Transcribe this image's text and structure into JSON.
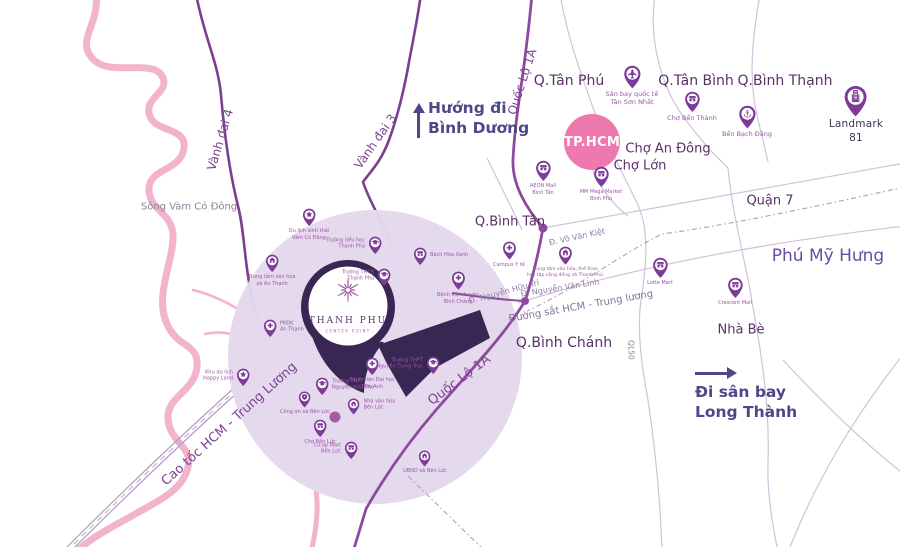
{
  "colors": {
    "pin": "#7d3a97",
    "pin_dark": "#382653",
    "river": "#f2b3cc",
    "zone": "#e4d8ec",
    "hub_circle": "#ee79ae",
    "road_ring": "#7a3f8e",
    "road_ql1a": "#8e4a9e",
    "road_thin": "#cfc2da",
    "rail": "#a9a0b5",
    "direction_text": "#4d4888",
    "junction": "#a45ba4"
  },
  "logo": {
    "name": "THANH PHU",
    "subtitle": "CENTER POINT",
    "icon": "starburst-icon"
  },
  "hub": {
    "text": "TP.HCM"
  },
  "directions": [
    {
      "id": "binh-duong",
      "line1": "Hướng đi",
      "line2": "Bình Dương",
      "arrow": "up-arrow-icon"
    },
    {
      "id": "long-thanh",
      "line1": "Đi sân bay",
      "line2": "Long Thành",
      "arrow": "right-arrow-icon"
    }
  ],
  "labels": [
    {
      "text": "Sông Vàm Cỏ Đông",
      "cls": "water",
      "x": 189,
      "y": 207,
      "fs": 10
    },
    {
      "text": "Vành đai 4",
      "cls": "road",
      "x": 221,
      "y": 140,
      "fs": 12,
      "rot": -73
    },
    {
      "text": "Vành đai 3",
      "cls": "road",
      "x": 376,
      "y": 142,
      "fs": 12,
      "rot": -55
    },
    {
      "text": "Quốc Lộ 1A",
      "cls": "road",
      "x": 523,
      "y": 82,
      "fs": 12,
      "rot": -72
    },
    {
      "text": "Quốc Lộ 1A",
      "cls": "road",
      "x": 460,
      "y": 381,
      "fs": 13,
      "rot": -37
    },
    {
      "text": "Cao tốc HCM - Trung Lương",
      "cls": "road",
      "x": 230,
      "y": 425,
      "fs": 13,
      "rot": -42
    },
    {
      "text": "Q.Tân Phú",
      "cls": "district",
      "x": 569,
      "y": 81,
      "fs": 14
    },
    {
      "text": "Q.Tân Bình",
      "cls": "district",
      "x": 696,
      "y": 81,
      "fs": 14
    },
    {
      "text": "Q.Bình Thạnh",
      "cls": "district",
      "x": 785,
      "y": 81,
      "fs": 14
    },
    {
      "text": "Chợ An Đông",
      "cls": "district",
      "x": 668,
      "y": 150,
      "fs": 13
    },
    {
      "text": "Chợ Lớn",
      "cls": "district",
      "x": 640,
      "y": 167,
      "fs": 13
    },
    {
      "text": "Q.Bình Tân",
      "cls": "district",
      "x": 510,
      "y": 223,
      "fs": 13
    },
    {
      "text": "Q.Bình Chánh",
      "cls": "district",
      "x": 564,
      "y": 343,
      "fs": 14
    },
    {
      "text": "Quận 7",
      "cls": "district",
      "x": 770,
      "y": 202,
      "fs": 13
    },
    {
      "text": "Phú Mỹ Hưng",
      "cls": "big",
      "x": 828,
      "y": 257,
      "fs": 17
    },
    {
      "text": "Nhà Bè",
      "cls": "district",
      "x": 741,
      "y": 331,
      "fs": 13
    },
    {
      "text": "Đ. Võ Văn Kiệt",
      "cls": "roadsmall",
      "x": 577,
      "y": 237,
      "fs": 8,
      "rot": -12
    },
    {
      "text": "Đ. Nguyễn Văn Linh",
      "cls": "roadsmall",
      "x": 560,
      "y": 288,
      "fs": 8,
      "rot": -9
    },
    {
      "text": "Đ. Nguyễn Hữu Trí",
      "cls": "roadsmall",
      "x": 504,
      "y": 292,
      "fs": 8,
      "rot": -15
    },
    {
      "text": "Đường sắt HCM - Trung lương",
      "cls": "rail",
      "x": 581,
      "y": 307,
      "fs": 10,
      "rot": -10
    },
    {
      "text": "QL50",
      "cls": "roadsmall",
      "x": 630,
      "y": 350,
      "fs": 7.5,
      "rot": 90
    }
  ],
  "pois": [
    {
      "id": "san-bay-tan-son-nhat",
      "icon": "airplane",
      "label": "Sân bay quốc tế\nTân Sơn Nhất",
      "x": 632,
      "y": 88,
      "s": 0.78,
      "lp": "b",
      "fs": 6.5
    },
    {
      "id": "cho-ben-thanh",
      "icon": "market",
      "label": "Chợ Bến Thành",
      "x": 692,
      "y": 112,
      "s": 0.7,
      "lp": "b",
      "fs": 6.5
    },
    {
      "id": "ben-bach-dang",
      "icon": "anchor",
      "label": "Bến Bạch Đằng",
      "x": 747,
      "y": 128,
      "s": 0.78,
      "lp": "b",
      "fs": 6.5
    },
    {
      "id": "landmark-81",
      "icon": "building",
      "label": "Landmark 81",
      "x": 856,
      "y": 116,
      "s": 1.05,
      "lp": "b",
      "fs": 10.5,
      "lc": "dark"
    },
    {
      "id": "aeon-mall-binh-tan",
      "icon": "market",
      "label": "AEON Mall\nBình Tân",
      "x": 543,
      "y": 181,
      "s": 0.7,
      "lp": "b",
      "fs": 5
    },
    {
      "id": "mm-mega-market-binh-phu",
      "icon": "market",
      "label": "MM Mega Market\nBình Phú",
      "x": 601,
      "y": 187,
      "s": 0.7,
      "lp": "b",
      "fs": 5
    },
    {
      "id": "lotte-mart",
      "icon": "market",
      "label": "Lotte Mart",
      "x": 660,
      "y": 278,
      "s": 0.7,
      "lp": "b",
      "fs": 5
    },
    {
      "id": "crescent-mall",
      "icon": "market",
      "label": "Crescent Mall",
      "x": 735,
      "y": 298,
      "s": 0.7,
      "lp": "b",
      "fs": 5
    },
    {
      "id": "campus-y-te",
      "icon": "cross",
      "label": "Campus Y tế",
      "x": 509,
      "y": 260,
      "s": 0.62,
      "lp": "b",
      "fs": 5
    },
    {
      "id": "ttvh-the-thao-thanh-phu",
      "icon": "house",
      "label": "Trung tâm văn hóa, thể thao\nhọc tập cộng đồng xã Thanh Phú",
      "x": 565,
      "y": 265,
      "s": 0.62,
      "lp": "b",
      "fs": 4.6
    },
    {
      "id": "du-lich-sinh-thai",
      "icon": "star",
      "label": "Du lịch sinh thái\nVàm Cỏ Đông",
      "x": 309,
      "y": 226,
      "s": 0.6,
      "lp": "b",
      "fs": 5
    },
    {
      "id": "ttvh-xa-an-thanh",
      "icon": "house",
      "label": "Trung tâm văn hóa\nxã An Thạnh",
      "x": 272,
      "y": 272,
      "s": 0.6,
      "lp": "b",
      "fs": 5
    },
    {
      "id": "truong-th-thanh-phu",
      "icon": "graduation-cap",
      "label": "Trường tiểu học\nThạnh Phú",
      "x": 375,
      "y": 254,
      "s": 0.6,
      "lp": "l",
      "fs": 5
    },
    {
      "id": "bach-hoa-xanh",
      "icon": "market",
      "label": "Bách Hóa Xanh",
      "x": 420,
      "y": 265,
      "s": 0.6,
      "lp": "r",
      "fs": 5
    },
    {
      "id": "truong-thcs-thanh-phu",
      "icon": "graduation-cap",
      "label": "Trường THCS\nThạnh Phú",
      "x": 384,
      "y": 286,
      "s": 0.6,
      "lp": "l",
      "fs": 5
    },
    {
      "id": "bv-huyen-binh-chanh",
      "icon": "cross",
      "label": "Bệnh viện huyện\nBình Chánh",
      "x": 458,
      "y": 290,
      "s": 0.62,
      "lp": "b",
      "fs": 5
    },
    {
      "id": "pkdk-an-thanh",
      "icon": "cross",
      "label": "PKĐK\nAn Thạnh",
      "x": 270,
      "y": 337,
      "s": 0.6,
      "lp": "r",
      "fs": 5
    },
    {
      "id": "happy-land",
      "icon": "star",
      "label": "Khu du lịch\nHappy Land",
      "x": 243,
      "y": 386,
      "s": 0.6,
      "lp": "l",
      "fs": 5
    },
    {
      "id": "bv-dai-hoc-tam-anh",
      "icon": "cross",
      "label": "Bệnh viện Đại học\nTâm Anh",
      "x": 372,
      "y": 375,
      "s": 0.6,
      "lp": "b",
      "fs": 5
    },
    {
      "id": "thpt-nguyen-trung-truc",
      "icon": "graduation-cap",
      "label": "Trường THPT\nNguyễn Trung Trực",
      "x": 433,
      "y": 374,
      "s": 0.6,
      "lp": "l",
      "fs": 5
    },
    {
      "id": "thpt-nguyen-huu-tho",
      "icon": "graduation-cap",
      "label": "Trường THPT\nNguyễn Hữu Thọ",
      "x": 322,
      "y": 395,
      "s": 0.6,
      "lp": "r",
      "fs": 5
    },
    {
      "id": "cong-an-xa-ben-luc",
      "icon": "shield",
      "label": "Công an xã Bến Lức",
      "x": 305,
      "y": 407,
      "s": 0.55,
      "lp": "b",
      "fs": 5
    },
    {
      "id": "nha-van-hoa-ben-luc",
      "icon": "house",
      "label": "Nhà văn hóa\nBến Lức",
      "x": 354,
      "y": 414,
      "s": 0.55,
      "lp": "r",
      "fs": 5
    },
    {
      "id": "cho-ben-luc",
      "icon": "market",
      "label": "Chợ Bến Lức",
      "x": 320,
      "y": 437,
      "s": 0.6,
      "lp": "b",
      "fs": 5
    },
    {
      "id": "coop-mart-ben-luc",
      "icon": "market",
      "label": "Co.op Mart\nBến Lức",
      "x": 351,
      "y": 459,
      "s": 0.6,
      "lp": "l",
      "fs": 5
    },
    {
      "id": "ubnd-xa-ben-luc",
      "icon": "house",
      "label": "UBND xã Bến Lức",
      "x": 425,
      "y": 466,
      "s": 0.55,
      "lp": "b",
      "fs": 5
    }
  ]
}
